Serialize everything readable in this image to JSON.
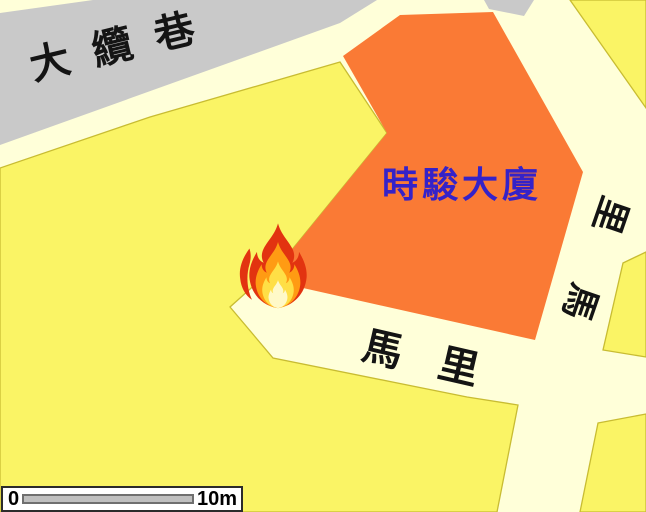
{
  "map": {
    "streets": {
      "top_street": "大纜巷",
      "bottom_street": "馬里",
      "right_street": "里馬"
    },
    "building_label": "時駿大廈",
    "fire_icon": "flame",
    "colors": {
      "road": "#ffffd9",
      "road_gray": "#c9c9c9",
      "block_yellow": "#faf465",
      "block_border": "#c8bc32",
      "building_orange": "#fa7a35",
      "building_text": "#3522c8",
      "street_text": "#141414",
      "flame_outer": "#e23310",
      "flame_mid": "#ff9b13",
      "flame_inner": "#ffdf46",
      "flame_core": "#fff9c8"
    }
  },
  "scale_bar": {
    "zero_label": "0",
    "distance_label": "10m"
  }
}
